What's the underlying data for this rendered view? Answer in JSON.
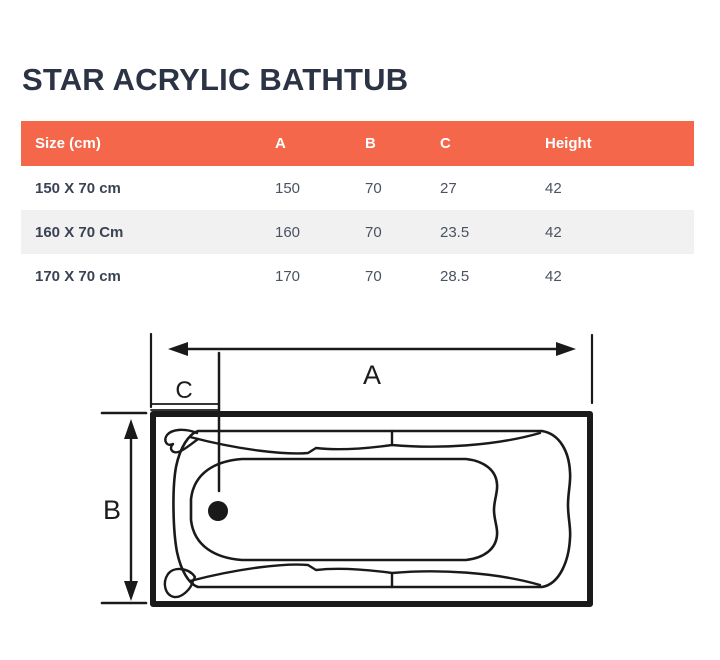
{
  "title": "STAR ACRYLIC BATHTUB",
  "table": {
    "columns": [
      "Size (cm)",
      "A",
      "B",
      "C",
      "Height"
    ],
    "rows": [
      {
        "size": "150 X 70 cm",
        "a": "150",
        "b": "70",
        "c": "27",
        "height": "42"
      },
      {
        "size": "160 X 70 Cm",
        "a": "160",
        "b": "70",
        "c": "23.5",
        "height": "42"
      },
      {
        "size": "170 X 70 cm",
        "a": "170",
        "b": "70",
        "c": "28.5",
        "height": "42"
      }
    ],
    "colors": {
      "header_bg": "#F4674B",
      "header_text": "#FFFFFF",
      "alt_row_bg": "#F1F1F2",
      "body_text": "#4A5261",
      "title_text": "#2B3345"
    }
  },
  "diagram": {
    "labels": {
      "a": "A",
      "b": "B",
      "c": "C"
    },
    "line_color": "#1A1A1A"
  }
}
